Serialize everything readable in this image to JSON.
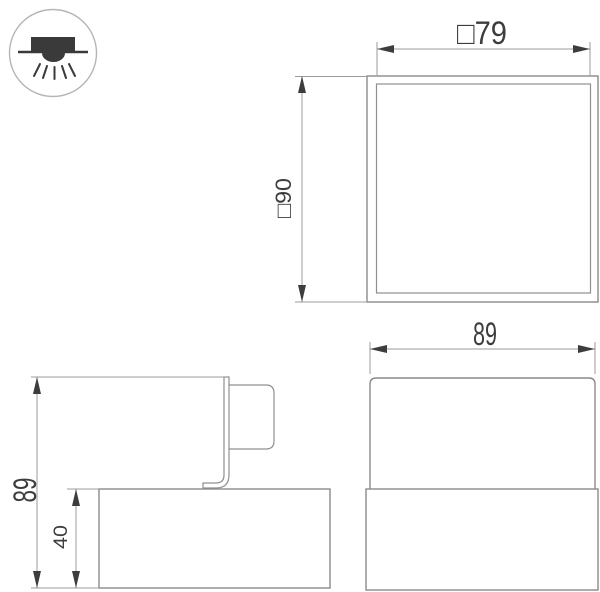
{
  "page": {
    "background": "#ffffff"
  },
  "colors": {
    "shape_outline": "#8a8a8a",
    "dimension_line": "#9b9b9b",
    "text_and_arrows": "#3d3d3d",
    "icon_fill": "#3a3a3a",
    "icon_circle_outline": "#b5b5b5"
  },
  "icon": {
    "name": "surface-mounted-downlight-icon"
  },
  "views": {
    "top_view": {
      "inner_width_dim": "□79",
      "outer_size_dim": "□90"
    },
    "front_view": {
      "width_dim": "89"
    },
    "side_view": {
      "total_height_dim": "89",
      "body_height_dim": "40"
    }
  }
}
